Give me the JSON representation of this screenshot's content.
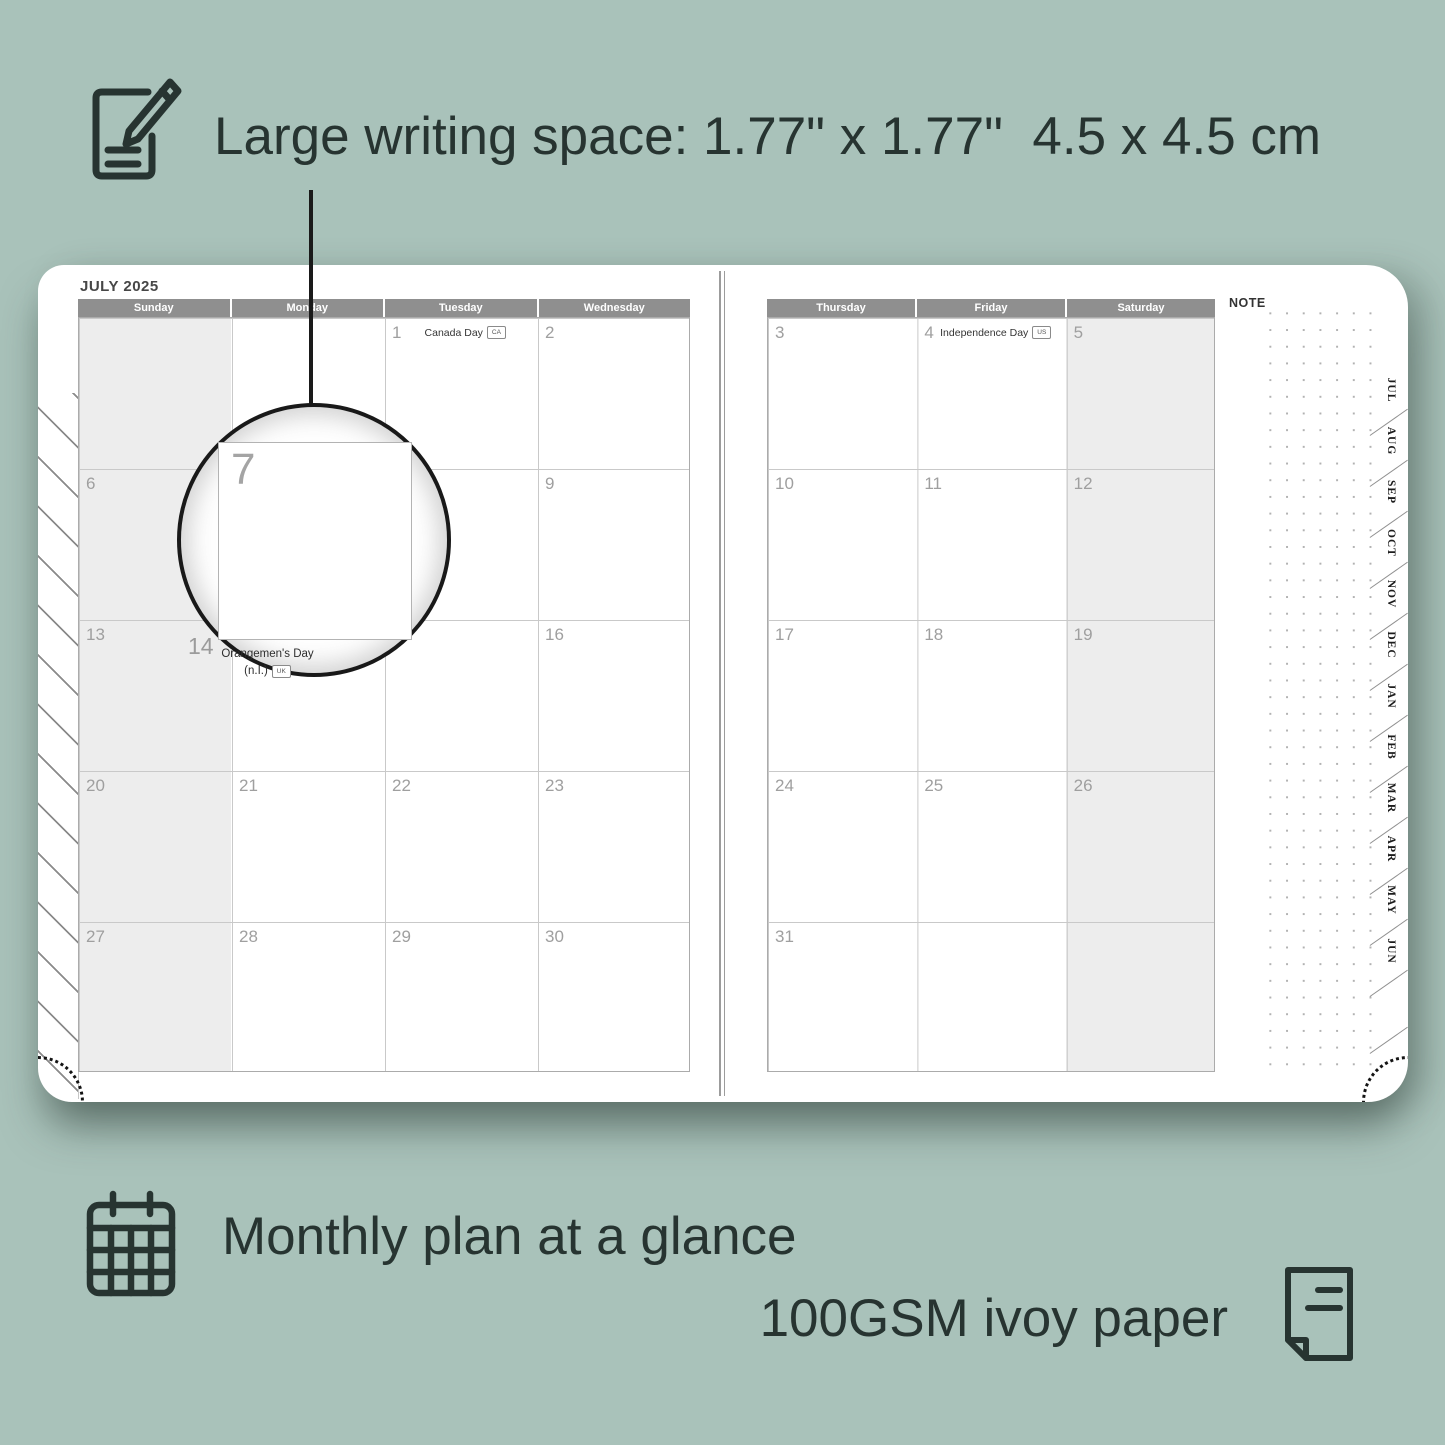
{
  "annotation_top": {
    "text": "Large writing space: 1.77\" x 1.77\"  4.5 x 4.5 cm"
  },
  "captions": {
    "monthly": "Monthly plan at a glance",
    "paper": "100GSM ivoy paper"
  },
  "planner": {
    "month_title": "JULY 2025",
    "note_label": "NOTE",
    "left_days": [
      "Sunday",
      "Monday",
      "Tuesday",
      "Wednesday"
    ],
    "right_days": [
      "Thursday",
      "Friday",
      "Saturday"
    ],
    "tabs": [
      "JUL",
      "AUG",
      "SEP",
      "OCT",
      "NOV",
      "DEC",
      "JAN",
      "FEB",
      "MAR",
      "APR",
      "MAY",
      "JUN"
    ],
    "cells": [
      {
        "page": "left",
        "row": 0,
        "col": 2,
        "date": "1",
        "holiday": "Canada Day",
        "flag": "CA"
      },
      {
        "page": "left",
        "row": 0,
        "col": 3,
        "date": "2"
      },
      {
        "page": "left",
        "row": 1,
        "col": 0,
        "date": "6"
      },
      {
        "page": "left",
        "row": 1,
        "col": 3,
        "date": "9"
      },
      {
        "page": "left",
        "row": 2,
        "col": 0,
        "date": "13"
      },
      {
        "page": "left",
        "row": 2,
        "col": 3,
        "date": "16"
      },
      {
        "page": "left",
        "row": 3,
        "col": 0,
        "date": "20"
      },
      {
        "page": "left",
        "row": 3,
        "col": 1,
        "date": "21"
      },
      {
        "page": "left",
        "row": 3,
        "col": 2,
        "date": "22"
      },
      {
        "page": "left",
        "row": 3,
        "col": 3,
        "date": "23"
      },
      {
        "page": "left",
        "row": 4,
        "col": 0,
        "date": "27"
      },
      {
        "page": "left",
        "row": 4,
        "col": 1,
        "date": "28"
      },
      {
        "page": "left",
        "row": 4,
        "col": 2,
        "date": "29"
      },
      {
        "page": "left",
        "row": 4,
        "col": 3,
        "date": "30"
      },
      {
        "page": "right",
        "row": 0,
        "col": 0,
        "date": "3"
      },
      {
        "page": "right",
        "row": 0,
        "col": 1,
        "date": "4",
        "holiday": "Independence Day",
        "flag": "US"
      },
      {
        "page": "right",
        "row": 0,
        "col": 2,
        "date": "5"
      },
      {
        "page": "right",
        "row": 1,
        "col": 0,
        "date": "10"
      },
      {
        "page": "right",
        "row": 1,
        "col": 1,
        "date": "11"
      },
      {
        "page": "right",
        "row": 1,
        "col": 2,
        "date": "12"
      },
      {
        "page": "right",
        "row": 2,
        "col": 0,
        "date": "17"
      },
      {
        "page": "right",
        "row": 2,
        "col": 1,
        "date": "18"
      },
      {
        "page": "right",
        "row": 2,
        "col": 2,
        "date": "19"
      },
      {
        "page": "right",
        "row": 3,
        "col": 0,
        "date": "24"
      },
      {
        "page": "right",
        "row": 3,
        "col": 1,
        "date": "25"
      },
      {
        "page": "right",
        "row": 3,
        "col": 2,
        "date": "26"
      },
      {
        "page": "right",
        "row": 4,
        "col": 0,
        "date": "31"
      }
    ],
    "magnified_cell": {
      "date": "7"
    },
    "special_cell": {
      "date": "14",
      "holiday_line1": "Orangemen's Day",
      "holiday_line2": "(n.I.)",
      "flag": "UK"
    }
  },
  "colors": {
    "background": "#a9c2ba",
    "ink": "#273431",
    "header_bar": "#8f8f8f",
    "shaded_column": "#ededed",
    "grid_line": "#c9c9c9",
    "date_number": "#9f9f9f"
  }
}
